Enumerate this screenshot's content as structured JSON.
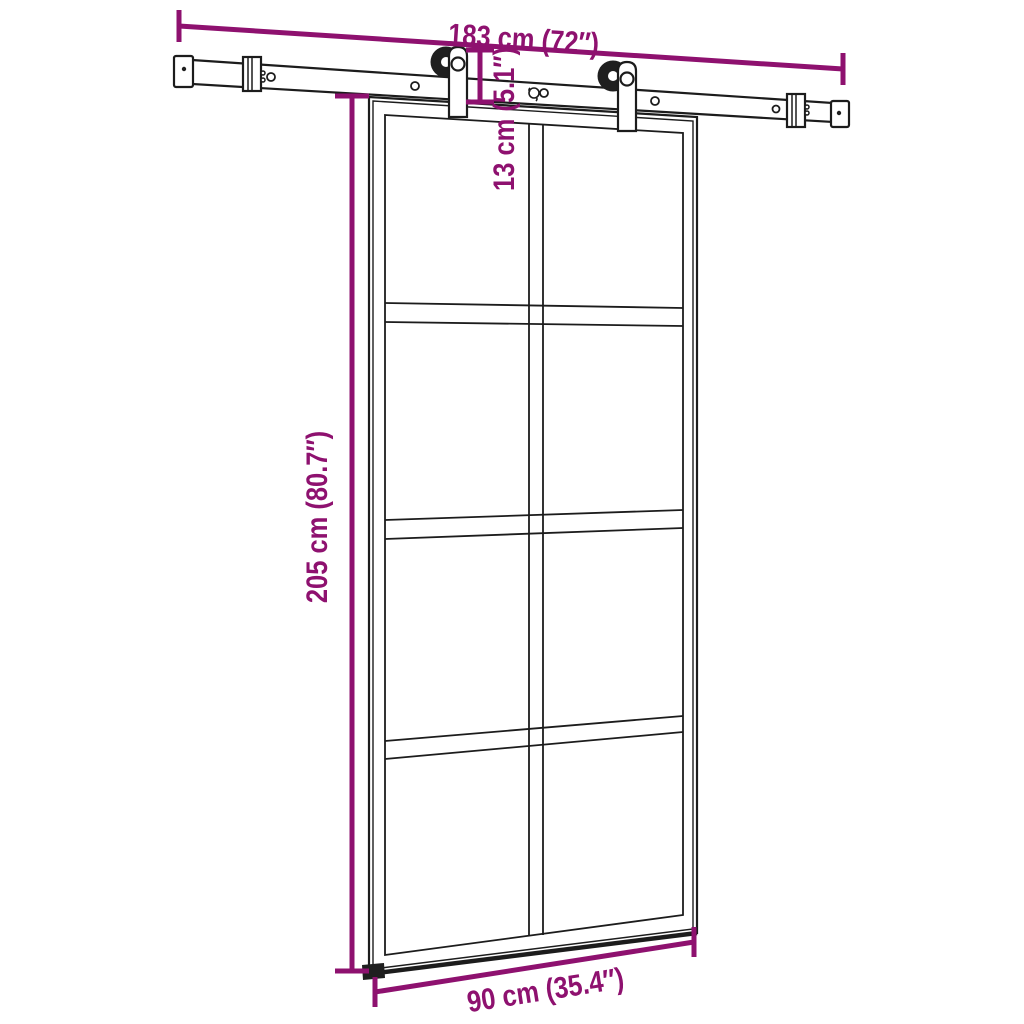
{
  "diagram": {
    "background_color": "#ffffff",
    "line_color": "#1c1c1c",
    "dimension_color": "#8E116F",
    "door": {
      "glass_rows": 4,
      "glass_columns": 2,
      "rollers": 2
    },
    "dimensions": {
      "rail_width": {
        "label": "183 cm (72″)"
      },
      "clearance_height": {
        "label": "13 cm (5.1″)"
      },
      "door_height": {
        "label": "205 cm (80.7″)"
      },
      "door_width": {
        "label": "90 cm (35.4″)"
      }
    }
  }
}
